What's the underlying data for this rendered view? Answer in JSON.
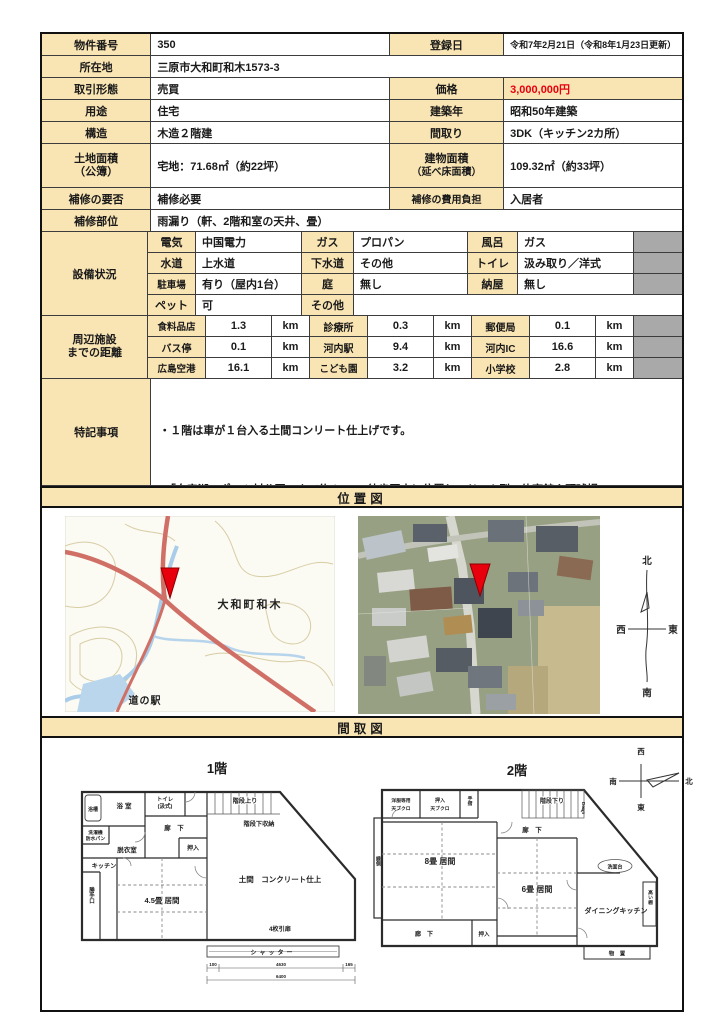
{
  "table": {
    "r1": {
      "l1": "物件番号",
      "v1": "350",
      "l2": "登録日",
      "v2": "令和7年2月21日（令和8年1月23日更新）"
    },
    "r2": {
      "l1": "所在地",
      "v1": "三原市大和町和木1573-3"
    },
    "r3": {
      "l1": "取引形態",
      "v1": "売買",
      "l2": "価格",
      "v2": "3,000,000円"
    },
    "r4": {
      "l1": "用途",
      "v1": "住宅",
      "l2": "建築年",
      "v2": "昭和50年建築"
    },
    "r5": {
      "l1": "構造",
      "v1": "木造２階建",
      "l2": "間取り",
      "v2": "3DK（キッチン2カ所）"
    },
    "r6": {
      "l1a": "土地面積",
      "l1b": "（公簿）",
      "v1": "宅地：71.68㎡（約22坪）",
      "l2a": "建物面積",
      "l2b": "（延べ床面積）",
      "v2": "109.32㎡（約33坪）"
    },
    "r7": {
      "l1": "補修の要否",
      "v1": "補修必要",
      "l2": "補修の費用負担",
      "v2": "入居者"
    },
    "r8": {
      "l1": "補修部位",
      "v1": "雨漏り（軒、2階和室の天井、畳）"
    }
  },
  "equipment": {
    "title": "設備状況",
    "rows": [
      {
        "l1": "電気",
        "v1": "中国電力",
        "l2": "ガス",
        "v2": "プロパン",
        "l3": "風呂",
        "v3": "ガス"
      },
      {
        "l1": "水道",
        "v1": "上水道",
        "l2": "下水道",
        "v2": "その他",
        "l3": "トイレ",
        "v3": "汲み取り／洋式"
      },
      {
        "l1": "駐車場",
        "v1": "有り（屋内1台）",
        "l2": "庭",
        "v2": "無し",
        "l3": "納屋",
        "v3": "無し"
      },
      {
        "l1": "ペット",
        "v1": "可",
        "l2": "その他",
        "v2": ""
      }
    ]
  },
  "facilities": {
    "title1": "周辺施設",
    "title2": "までの距離",
    "rows": [
      {
        "n1": "食料品店",
        "d1": "1.3",
        "u1": "km",
        "n2": "診療所",
        "d2": "0.3",
        "u2": "km",
        "n3": "郵便局",
        "d3": "0.1",
        "u3": "km"
      },
      {
        "n1": "バス停",
        "d1": "0.1",
        "u1": "km",
        "n2": "河内駅",
        "d2": "9.4",
        "u2": "km",
        "n3": "河内IC",
        "d3": "16.6",
        "u3": "km"
      },
      {
        "n1": "広島空港",
        "d1": "16.1",
        "u1": "km",
        "n2": "こども園",
        "d2": "3.2",
        "u2": "km",
        "n3": "小学校",
        "d3": "2.8",
        "u3": "km"
      }
    ]
  },
  "notes": {
    "title": "特記事項",
    "lines": [
      "・１階は車が１台入る土間コンリート仕上げです。",
      "・「白竜湖スポーツ村公園」まで約１kmの徒歩圏内に位置し、ドーム型の体育館や野球場、",
      "　総合運動場、テニス場、フットサル場、こども広場などがあります。また、例年４月の",
      "　「白竜湖花火inだいわ」の会場近くでもあります。",
      "・イオンネットスーパー配達圏内（令和7年1月現在）"
    ]
  },
  "sections": {
    "location": "位置図",
    "floorplan": "間取図"
  },
  "map": {
    "area": "大和町和木",
    "station": "道の駅",
    "compass": {
      "n": "北",
      "s": "南",
      "e": "東",
      "w": "西"
    }
  },
  "fp": {
    "f1": "1階",
    "f2": "2階",
    "compass": {
      "n": "北",
      "s": "南",
      "e": "東",
      "w": "西"
    },
    "f1l": {
      "bath_tub": "浴槽",
      "bath": "浴室",
      "toilet1": "トイレ",
      "toilet2": "(汲式)",
      "washer1": "洗濯機",
      "washer2": "防水パン",
      "dressing": "脱衣室",
      "hall": "廊　下",
      "closet": "押入",
      "stairs_up": "階段上り",
      "under_stairs": "階段下収納",
      "kitchen": "キッチン",
      "back_door": "勝手口",
      "living": "4.5畳 居間",
      "doma": "土間　コンクリート仕上",
      "door4": "4枚引扉",
      "shutter": "シャッター",
      "dim1": "100",
      "dim2": "4630",
      "dim3": "165",
      "dim_total": "6400"
    },
    "f2l": {
      "wardrobe1": "洋服等用",
      "wardrobe2": "天ブクロ",
      "closet_top1": "押入",
      "closet_top2": "天ブクロ",
      "rail": "手摺",
      "stairs_down": "階段下り",
      "down": "Down",
      "hall_top": "廊　下",
      "living8": "8畳 居間",
      "living6": "6畳 居間",
      "closet": "押入",
      "hall_bottom": "廊　下",
      "veranda": "縁側",
      "wash": "洗面台",
      "dining": "ダイニングキッチン",
      "shelf": "高い棚",
      "storage": "物　置"
    }
  }
}
